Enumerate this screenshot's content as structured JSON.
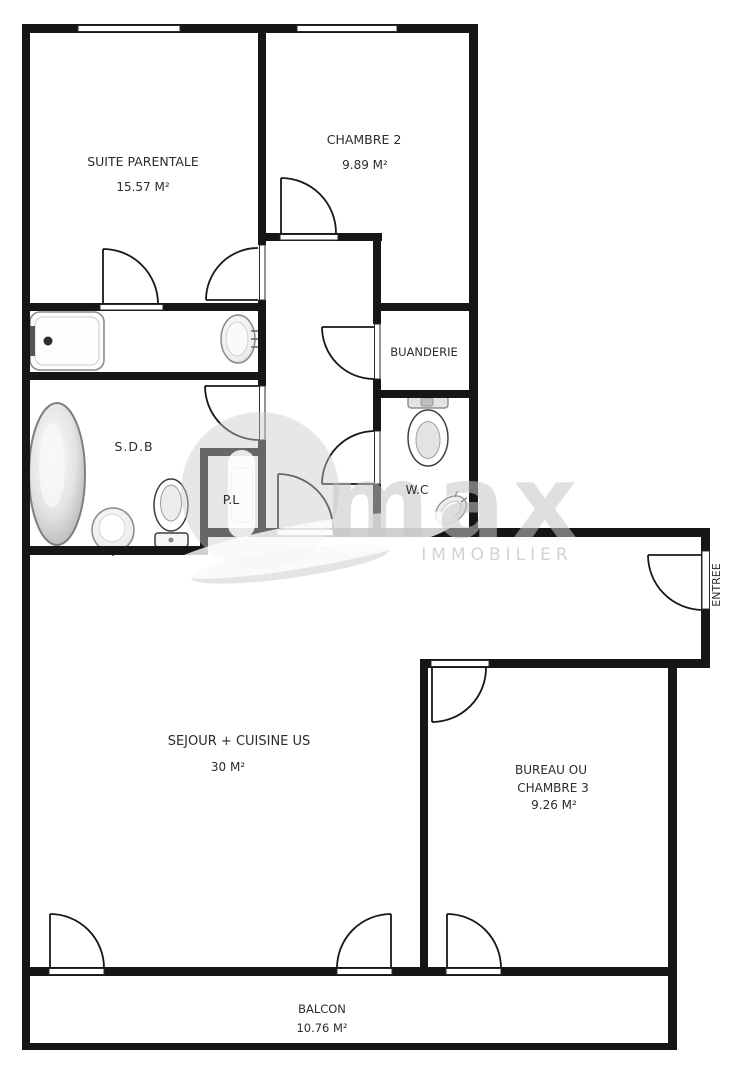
{
  "rooms": {
    "suite_parentale": {
      "name": "SUITE PARENTALE",
      "area": "15.57 M²"
    },
    "chambre2": {
      "name": "CHAMBRE 2",
      "area": "9.89 M²"
    },
    "buanderie": {
      "name": "BUANDERIE"
    },
    "sdb": {
      "name": "S.D.B"
    },
    "placard": {
      "name": "P.L"
    },
    "wc": {
      "name": "W.C"
    },
    "entree": {
      "name": "ENTREE"
    },
    "sejour": {
      "name": "SEJOUR + CUISINE US",
      "area": "30 M²"
    },
    "bureau": {
      "name_line1": "BUREAU OU",
      "name_line2": "CHAMBRE 3",
      "area": "9.26 M²"
    },
    "balcon": {
      "name": "BALCON",
      "area": "10.76 M²"
    }
  },
  "watermark": {
    "brand_text": "max",
    "tagline": "IMMOBILIER"
  },
  "colors": {
    "wall": "#161616",
    "label": "#2c2c2c",
    "watermark_gray": "#c9c9c9",
    "fixture_stroke": "#8a8a8a"
  }
}
